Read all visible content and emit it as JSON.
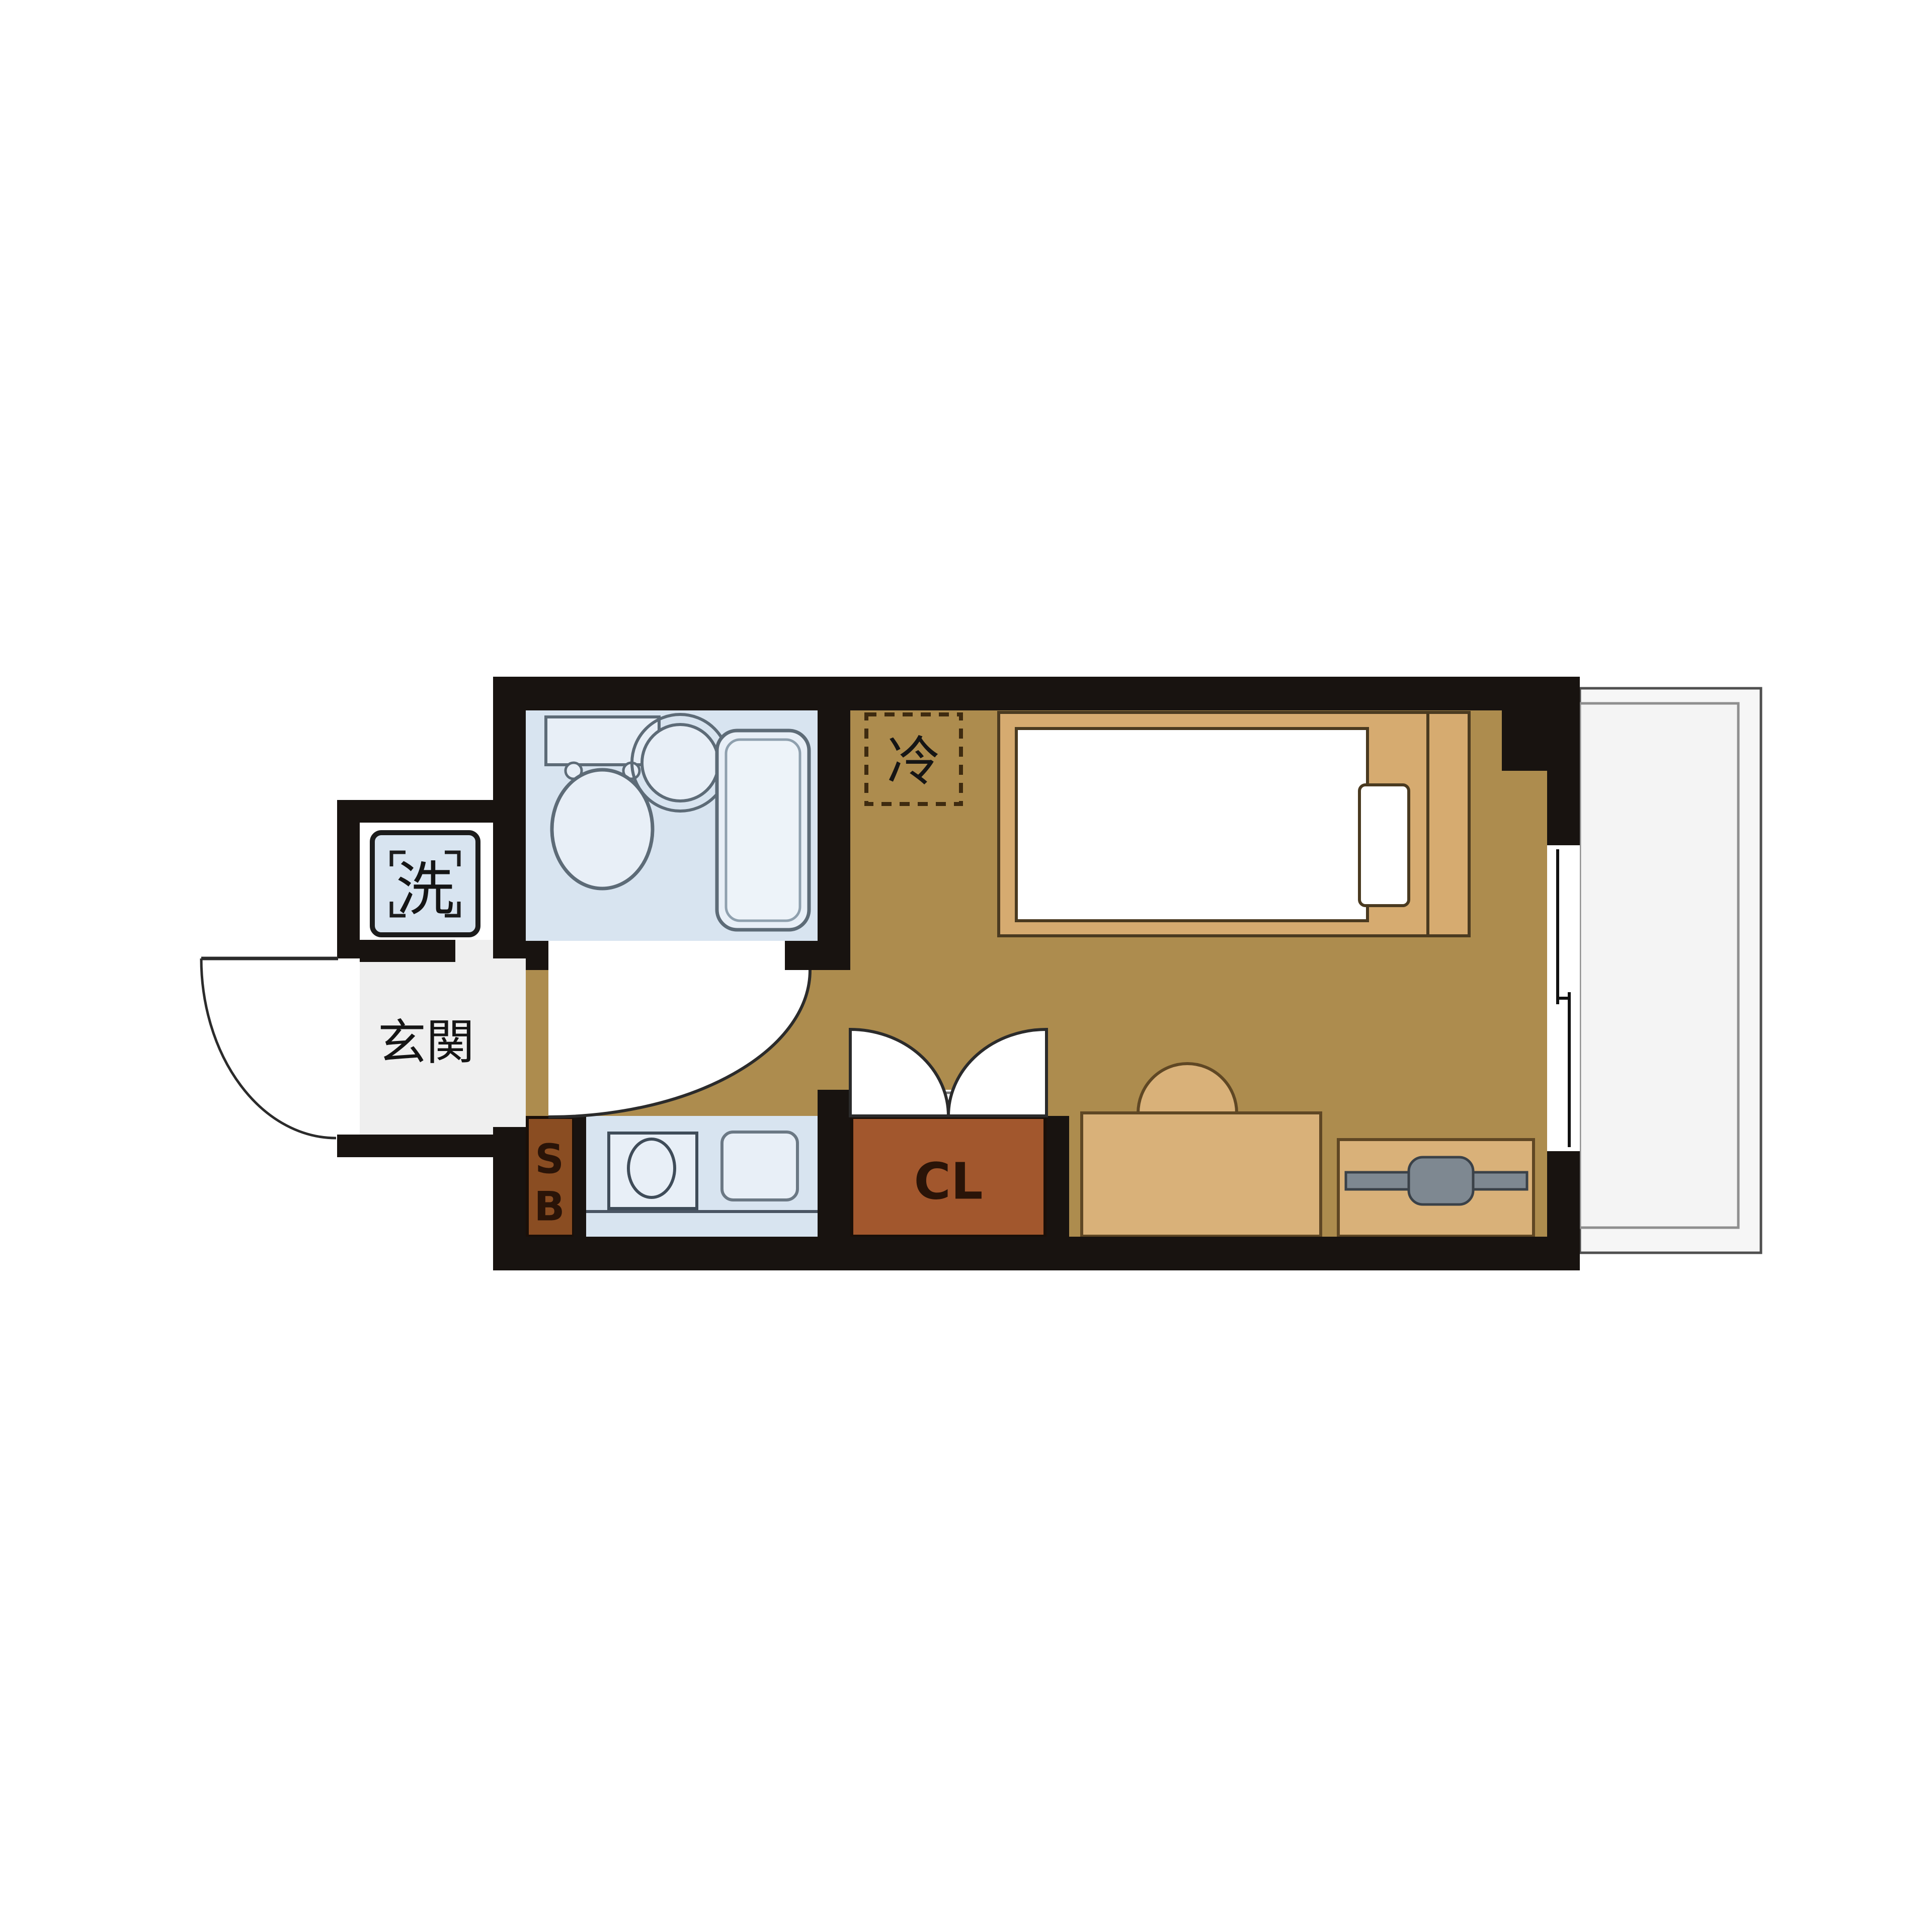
{
  "page": {
    "kind": "japanese-apartment-floor-plan",
    "background": "#ffffff"
  },
  "labels": {
    "washing_machine": "洗",
    "entrance": "玄関",
    "refrigerator": "冷",
    "shoe_box_line1": "S",
    "shoe_box_line2": "B",
    "closet": "CL"
  },
  "colors": {
    "wall": "#181310",
    "floor": "#ad8c4e",
    "wet_area": "#d8e4f0",
    "fixture_fill": "#e8eff7",
    "fixture_line": "#5d6b77",
    "furniture": "#d9b179",
    "bed_frame": "#d6ab70",
    "furniture_line": "#5f4724",
    "mattress": "#ffffff",
    "closet": "#a2572d",
    "shoe_box": "#8a4d22",
    "dark_label": "#2a1408",
    "entrance_floor": "#efefef",
    "balcony_fill": "#f6f6f6",
    "balcony_outer_line": "#4f4f4f",
    "balcony_inner_line": "#8f8f8f",
    "tv": "#7e8891",
    "tv_line": "#3a4148",
    "fridge_dash": "#3e2b10",
    "door_line": "#2b2b2b",
    "white": "#ffffff"
  }
}
